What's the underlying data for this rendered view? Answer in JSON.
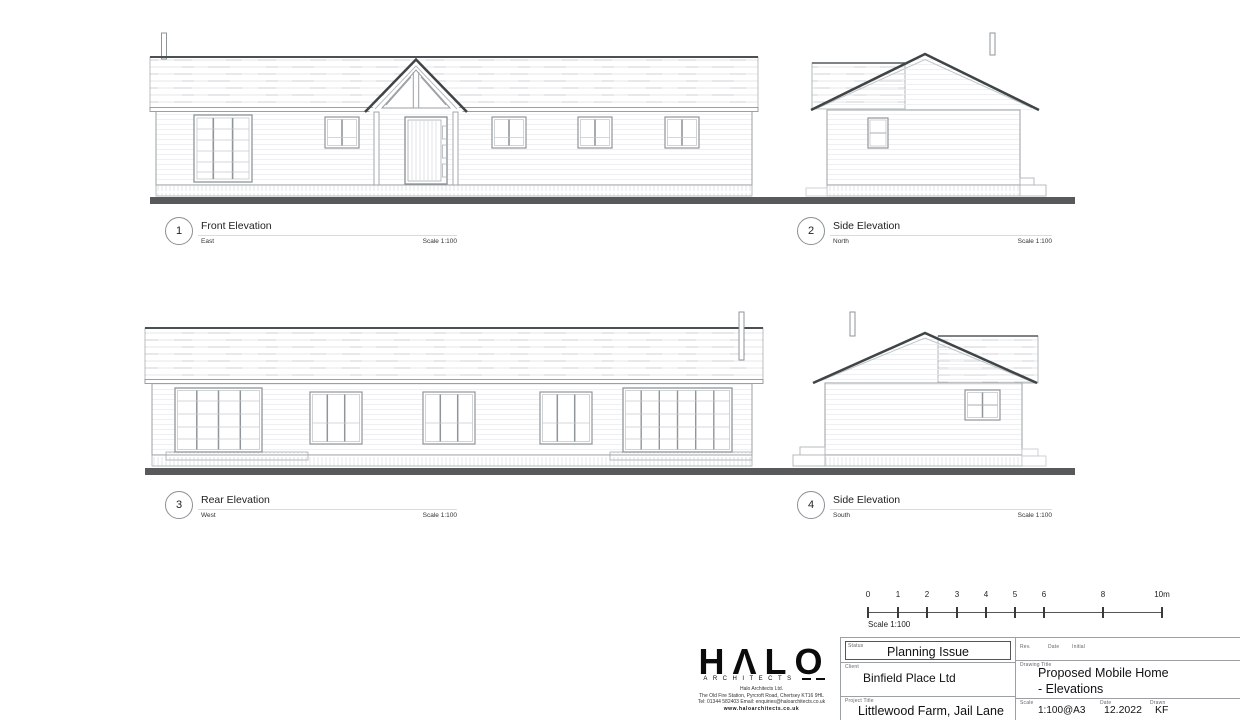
{
  "elevations": [
    {
      "number": "1",
      "title": "Front Elevation",
      "direction": "East",
      "scale": "Scale 1:100"
    },
    {
      "number": "2",
      "title": "Side Elevation",
      "direction": "North",
      "scale": "Scale 1:100"
    },
    {
      "number": "3",
      "title": "Rear Elevation",
      "direction": "West",
      "scale": "Scale 1:100"
    },
    {
      "number": "4",
      "title": "Side Elevation",
      "direction": "South",
      "scale": "Scale 1:100"
    }
  ],
  "scalebar": {
    "ticks": [
      "0",
      "1",
      "2",
      "3",
      "4",
      "5",
      "6",
      "8",
      "10m"
    ],
    "caption": "Scale 1:100"
  },
  "titleblock": {
    "logo_text": "HΛLO",
    "logo_subtext": "ARCHITECTS",
    "address_lines": [
      "Halo Architects Ltd.",
      "The Old Fire Station, Pyrcroft Road, Chertsey KT16 9HL",
      "Tel: 01344 582403 Email: enquiries@haloarchitects.co.uk",
      "www.haloarchitects.co.uk"
    ],
    "status_label": "Status",
    "status_value": "Planning Issue",
    "client_label": "Client",
    "client_value": "Binfield Place Ltd",
    "project_label": "Project Title",
    "project_value": "Littlewood Farm, Jail Lane",
    "revision_headers": {
      "rev": "Rev.",
      "date": "Date",
      "initial": "Initial"
    },
    "drawing_title_label": "Drawing Title",
    "drawing_title_line1": "Proposed Mobile Home",
    "drawing_title_line2": "- Elevations",
    "scale_label": "Scale",
    "scale_value": "1:100@A3",
    "date_label": "Date",
    "date_value": "12.2022",
    "drawn_label": "Drawn",
    "drawn_value": "KF"
  },
  "colors": {
    "ground_bar": "#58595b",
    "roof_edge": "#3f4447",
    "drawing_line": "#9aa0a3"
  }
}
